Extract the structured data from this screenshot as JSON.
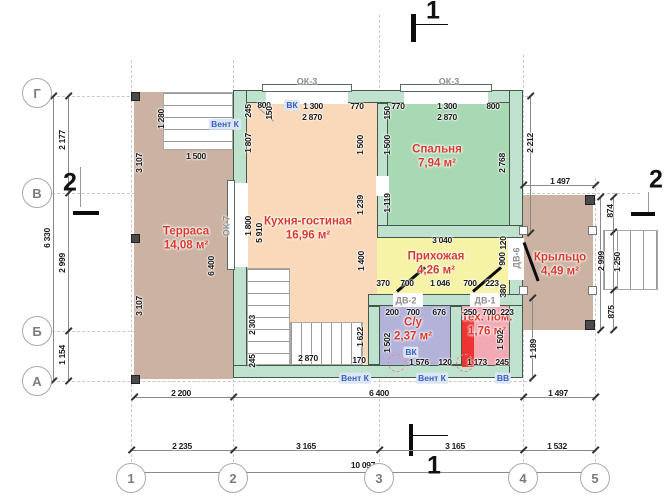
{
  "drawing": {
    "type": "floor-plan",
    "language": "ru",
    "colors": {
      "terrace": "#ccb2a2",
      "kitchen": "#f9d9ba",
      "bedroom": "#a9d8b4",
      "hallway": "#f6f2a6",
      "bathroom": "#b3b3da",
      "tech": "#f3a9b4",
      "porch": "#ccb2a2",
      "wall": "#bfe2cf",
      "wall_border": "#44584c",
      "room_label": "#d63c2e",
      "vent_label": "#3d5cc0",
      "equipment_red": "#ee3333"
    }
  },
  "rooms": [
    {
      "name": "Терраса",
      "area": "14,08 м²",
      "cx": 186,
      "cy": 232,
      "rect": [
        134,
        92,
        99,
        287
      ],
      "color": "#ccb2a2"
    },
    {
      "name": "Кухня-гостиная",
      "area": "16,96 м²",
      "cx": 308,
      "cy": 222,
      "rect": [
        247,
        103,
        130,
        262
      ],
      "color": "#f9d9ba"
    },
    {
      "name": "Спальня",
      "area": "7,94 м²",
      "cx": 437,
      "cy": 150,
      "rect": [
        388,
        103,
        121,
        122
      ],
      "color": "#a9d8b4"
    },
    {
      "name": "Прихожая",
      "area": "4,26 м²",
      "cx": 436,
      "cy": 257,
      "rect": [
        377,
        238,
        132,
        56
      ],
      "color": "#f6f2a6"
    },
    {
      "name": "Крыльцо",
      "area": "4,49 м²",
      "cx": 560,
      "cy": 258,
      "rect": [
        523,
        195,
        70,
        135
      ],
      "color": "#ccb2a2"
    },
    {
      "name": "С/у",
      "area": "2,37 м²",
      "cx": 413,
      "cy": 323,
      "rect": [
        380,
        306,
        70,
        59
      ],
      "color": "#b3b3da"
    },
    {
      "name": "Тех. пом.",
      "area": "1,76 м²",
      "cx": 487,
      "cy": 318,
      "rect": [
        462,
        306,
        47,
        59
      ],
      "color": "#f3a9b4"
    }
  ],
  "dimensions": [
    {
      "t": "245",
      "x": 248,
      "y": 111,
      "r": 1
    },
    {
      "t": "800",
      "x": 264,
      "y": 105
    },
    {
      "t": "1 300",
      "x": 313,
      "y": 106
    },
    {
      "t": "770",
      "x": 357,
      "y": 106
    },
    {
      "t": "2 870",
      "x": 312,
      "y": 117
    },
    {
      "t": "150",
      "x": 269,
      "y": 113,
      "r": 1
    },
    {
      "t": "1 807",
      "x": 248,
      "y": 143,
      "r": 1
    },
    {
      "t": "1 800",
      "x": 248,
      "y": 226,
      "r": 1
    },
    {
      "t": "5 910",
      "x": 259,
      "y": 233,
      "r": 1
    },
    {
      "t": "1 500",
      "x": 360,
      "y": 145,
      "r": 1
    },
    {
      "t": "1 239",
      "x": 360,
      "y": 205,
      "r": 1
    },
    {
      "t": "1 400",
      "x": 361,
      "y": 261,
      "r": 1
    },
    {
      "t": "1 622",
      "x": 360,
      "y": 337,
      "r": 1
    },
    {
      "t": "2 303",
      "x": 252,
      "y": 325,
      "r": 1
    },
    {
      "t": "245",
      "x": 252,
      "y": 361,
      "r": 1
    },
    {
      "t": "2 870",
      "x": 308,
      "y": 358
    },
    {
      "t": "170",
      "x": 359,
      "y": 360
    },
    {
      "t": "770",
      "x": 398,
      "y": 106
    },
    {
      "t": "1 300",
      "x": 447,
      "y": 106
    },
    {
      "t": "800",
      "x": 493,
      "y": 106
    },
    {
      "t": "2 870",
      "x": 447,
      "y": 117
    },
    {
      "t": "150",
      "x": 387,
      "y": 113,
      "r": 1
    },
    {
      "t": "1 500",
      "x": 387,
      "y": 145,
      "r": 1
    },
    {
      "t": "1 119",
      "x": 387,
      "y": 203,
      "r": 1
    },
    {
      "t": "2 768",
      "x": 502,
      "y": 163,
      "r": 1
    },
    {
      "t": "2 212",
      "x": 530,
      "y": 143,
      "r": 1
    },
    {
      "t": "3 040",
      "x": 442,
      "y": 240
    },
    {
      "t": "120",
      "x": 503,
      "y": 243,
      "r": 1
    },
    {
      "t": "900",
      "x": 502,
      "y": 259,
      "r": 1
    },
    {
      "t": "380",
      "x": 503,
      "y": 291,
      "r": 1
    },
    {
      "t": "370",
      "x": 383,
      "y": 283
    },
    {
      "t": "700",
      "x": 407,
      "y": 283
    },
    {
      "t": "1 046",
      "x": 440,
      "y": 283
    },
    {
      "t": "700",
      "x": 470,
      "y": 283
    },
    {
      "t": "223",
      "x": 492,
      "y": 283
    },
    {
      "t": "200",
      "x": 392,
      "y": 312
    },
    {
      "t": "700",
      "x": 413,
      "y": 312
    },
    {
      "t": "676",
      "x": 439,
      "y": 312
    },
    {
      "t": "1 502",
      "x": 387,
      "y": 343,
      "r": 1
    },
    {
      "t": "1 576",
      "x": 419,
      "y": 362
    },
    {
      "t": "120",
      "x": 445,
      "y": 362
    },
    {
      "t": "250",
      "x": 470,
      "y": 312
    },
    {
      "t": "700",
      "x": 489,
      "y": 312
    },
    {
      "t": "223",
      "x": 507,
      "y": 312
    },
    {
      "t": "1 173",
      "x": 477,
      "y": 362
    },
    {
      "t": "245",
      "x": 502,
      "y": 362
    },
    {
      "t": "1 502",
      "x": 500,
      "y": 340,
      "r": 1
    },
    {
      "t": "1 189",
      "x": 533,
      "y": 349,
      "r": 1
    },
    {
      "t": "1 280",
      "x": 161,
      "y": 119,
      "r": 1
    },
    {
      "t": "1 500",
      "x": 196,
      "y": 156
    },
    {
      "t": "3 107",
      "x": 139,
      "y": 163,
      "r": 1
    },
    {
      "t": "3 107",
      "x": 139,
      "y": 306,
      "r": 1
    },
    {
      "t": "6 400",
      "x": 211,
      "y": 266,
      "r": 1
    },
    {
      "t": "1 497",
      "x": 560,
      "y": 181
    },
    {
      "t": "874",
      "x": 610,
      "y": 211,
      "r": 1
    },
    {
      "t": "2 999",
      "x": 601,
      "y": 261,
      "r": 1
    },
    {
      "t": "1 250",
      "x": 617,
      "y": 262,
      "r": 1
    },
    {
      "t": "875",
      "x": 611,
      "y": 312,
      "r": 1
    },
    {
      "t": "2 177",
      "x": 62,
      "y": 140,
      "r": 1
    },
    {
      "t": "6 330",
      "x": 47,
      "y": 238,
      "r": 1
    },
    {
      "t": "2 999",
      "x": 62,
      "y": 263,
      "r": 1
    },
    {
      "t": "1 154",
      "x": 62,
      "y": 355,
      "r": 1
    },
    {
      "t": "2 200",
      "x": 181,
      "y": 393
    },
    {
      "t": "6 400",
      "x": 379,
      "y": 393
    },
    {
      "t": "1 497",
      "x": 558,
      "y": 393
    },
    {
      "t": "2 235",
      "x": 182,
      "y": 446
    },
    {
      "t": "3 165",
      "x": 306,
      "y": 446
    },
    {
      "t": "3 165",
      "x": 455,
      "y": 446
    },
    {
      "t": "1 532",
      "x": 557,
      "y": 446
    },
    {
      "t": "10 097",
      "x": 363,
      "y": 465
    }
  ],
  "opening_labels": [
    {
      "t": "ОК-3",
      "x": 307,
      "y": 82
    },
    {
      "t": "ОК-3",
      "x": 449,
      "y": 82
    },
    {
      "t": "ОК-7",
      "x": 227,
      "y": 226,
      "r": 1
    },
    {
      "t": "ДВ-2",
      "x": 406,
      "y": 301
    },
    {
      "t": "ДВ-1",
      "x": 485,
      "y": 301
    },
    {
      "t": "ДВ-6",
      "x": 517,
      "y": 258,
      "r": 1
    }
  ],
  "vent_labels": [
    {
      "t": "ВК",
      "x": 292,
      "y": 105
    },
    {
      "t": "Вент К",
      "x": 225,
      "y": 124
    },
    {
      "t": "ВК",
      "x": 411,
      "y": 352
    },
    {
      "t": "Вент К",
      "x": 355,
      "y": 378
    },
    {
      "t": "Вент К",
      "x": 432,
      "y": 378
    },
    {
      "t": "ВВ",
      "x": 503,
      "y": 378
    }
  ],
  "axes": {
    "rows": [
      {
        "label": "Г",
        "y": 93
      },
      {
        "label": "В",
        "y": 193
      },
      {
        "label": "Б",
        "y": 331
      },
      {
        "label": "А",
        "y": 381
      }
    ],
    "cols": [
      {
        "label": "1",
        "x": 131
      },
      {
        "label": "2",
        "x": 233
      },
      {
        "label": "3",
        "x": 379
      },
      {
        "label": "4",
        "x": 523
      },
      {
        "label": "5",
        "x": 595
      }
    ]
  },
  "section_markers": [
    {
      "label": "1",
      "x": 433,
      "y": 11
    },
    {
      "label": "1",
      "x": 434,
      "y": 466
    },
    {
      "label": "2",
      "x": 70,
      "y": 183
    },
    {
      "label": "2",
      "x": 656,
      "y": 180
    }
  ]
}
